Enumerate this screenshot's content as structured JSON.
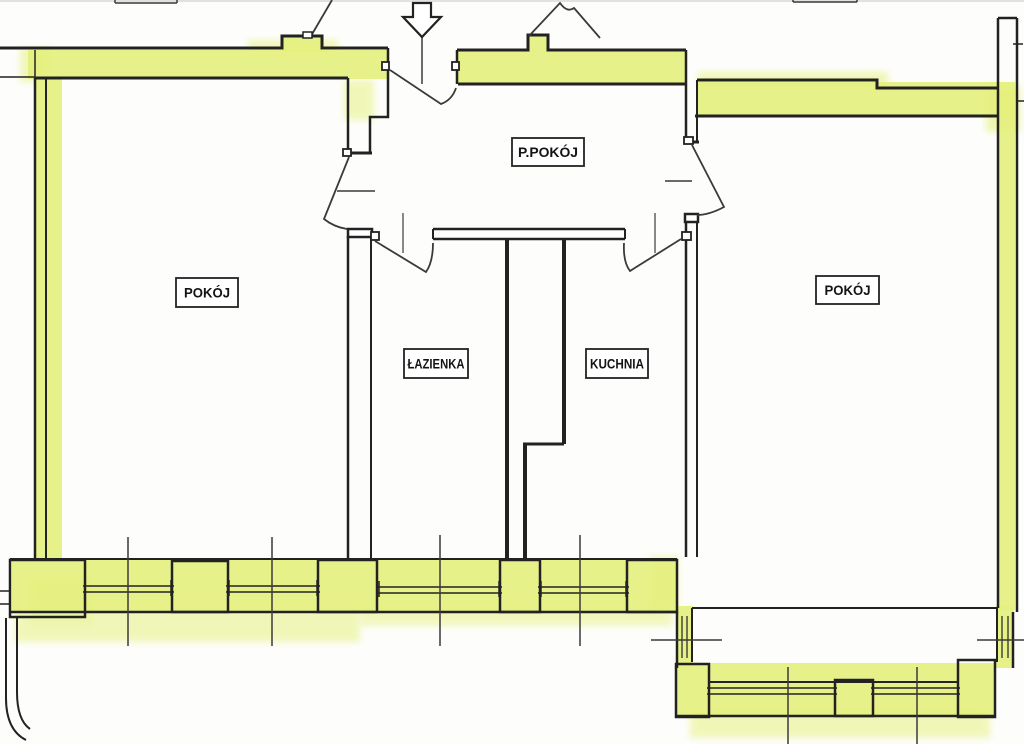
{
  "title": "Apartment floor plan scan",
  "colors": {
    "paper": "#fdfdfb",
    "wall": "#222222",
    "thin": "#3a3a3a",
    "hl": "#e4f07c",
    "hl_soft": "#edf5a8",
    "label_text": "#141414",
    "artifact": "#cfcfcc"
  },
  "labels": [
    {
      "name": "room-label-ppokoj",
      "text": "P.POKÓJ",
      "x": 512,
      "y": 138,
      "w": 72,
      "h": 28,
      "tl": 60
    },
    {
      "name": "room-label-pokoj-left",
      "text": "POKÓJ",
      "x": 176,
      "y": 278,
      "w": 62,
      "h": 29,
      "tl": 46
    },
    {
      "name": "room-label-lazienka",
      "text": "ŁAZIENKA",
      "x": 404,
      "y": 349,
      "w": 64,
      "h": 29,
      "tl": 57
    },
    {
      "name": "room-label-kuchnia",
      "text": "KUCHNIA",
      "x": 586,
      "y": 349,
      "w": 62,
      "h": 29,
      "tl": 54
    },
    {
      "name": "room-label-pokoj-right",
      "text": "POKÓJ",
      "x": 816,
      "y": 276,
      "w": 63,
      "h": 28,
      "tl": 46
    }
  ],
  "shapes": [
    {
      "t": "r",
      "name": "scan-artifact-top",
      "x": 0,
      "y": 0,
      "w": 1024,
      "h": 2,
      "f": "artifact",
      "s": "none",
      "op": 0.6
    },
    {
      "t": "r",
      "name": "hl-bleed-top-left",
      "x": 248,
      "y": 40,
      "w": 90,
      "h": 12,
      "f": "hl_soft",
      "s": "none",
      "op": 0.8,
      "blur": true
    },
    {
      "t": "r",
      "name": "hl-bleed-band-start",
      "x": 20,
      "y": 48,
      "w": 30,
      "h": 34,
      "f": "hl_soft",
      "s": "none",
      "op": 0.8,
      "blur": true
    },
    {
      "t": "r",
      "name": "hl-bleed-right-band",
      "x": 698,
      "y": 72,
      "w": 190,
      "h": 14,
      "f": "hl_soft",
      "s": "none",
      "op": 0.85,
      "blur": true
    },
    {
      "t": "r",
      "name": "hl-bleed-right-wall-top",
      "x": 986,
      "y": 86,
      "w": 34,
      "h": 46,
      "f": "hl_soft",
      "s": "none",
      "op": 0.9,
      "blur": true
    },
    {
      "t": "r",
      "name": "hl-bleed-pillar",
      "x": 344,
      "y": 80,
      "w": 30,
      "h": 40,
      "f": "hl_soft",
      "s": "none",
      "op": 0.8,
      "blur": true
    },
    {
      "t": "r",
      "name": "hl-bleed-corner-room",
      "x": 30,
      "y": 578,
      "w": 62,
      "h": 48,
      "f": "hl_soft",
      "s": "none",
      "op": 0.85,
      "blur": true
    },
    {
      "t": "r",
      "name": "hl-bleed-below-bottom",
      "x": 15,
      "y": 608,
      "w": 345,
      "h": 34,
      "f": "hl_soft",
      "s": "none",
      "op": 0.8,
      "blur": true
    },
    {
      "t": "r",
      "name": "hl-bleed-below-kitchen",
      "x": 360,
      "y": 606,
      "w": 312,
      "h": 20,
      "f": "hl_soft",
      "s": "none",
      "op": 0.75,
      "blur": true
    },
    {
      "t": "r",
      "name": "hl-bleed-bay-left",
      "x": 650,
      "y": 556,
      "w": 28,
      "h": 54,
      "f": "hl_soft",
      "s": "none",
      "op": 0.8,
      "blur": true
    },
    {
      "t": "r",
      "name": "hl-bleed-bay-bottom",
      "x": 690,
      "y": 710,
      "w": 300,
      "h": 28,
      "f": "hl_soft",
      "s": "none",
      "op": 0.8,
      "blur": true
    },
    {
      "t": "r",
      "name": "hl-top-left-band",
      "x": 28,
      "y": 50,
      "w": 360,
      "h": 29,
      "f": "hl",
      "s": "none",
      "op": 0.9
    },
    {
      "t": "r",
      "name": "hl-bump-left",
      "x": 282,
      "y": 37,
      "w": 40,
      "h": 15,
      "f": "hl",
      "s": "none",
      "op": 0.9
    },
    {
      "t": "r",
      "name": "hl-top-mid-band",
      "x": 458,
      "y": 51,
      "w": 228,
      "h": 33,
      "f": "hl",
      "s": "none",
      "op": 0.9
    },
    {
      "t": "r",
      "name": "hl-bump-mid",
      "x": 528,
      "y": 36,
      "w": 20,
      "h": 16,
      "f": "hl",
      "s": "none",
      "op": 0.9
    },
    {
      "t": "r",
      "name": "hl-right-room-band",
      "x": 697,
      "y": 82,
      "w": 318,
      "h": 34,
      "f": "hl",
      "s": "none",
      "op": 0.9
    },
    {
      "t": "r",
      "name": "hl-left-wall",
      "x": 36,
      "y": 79,
      "w": 26,
      "h": 480,
      "f": "hl",
      "s": "none",
      "op": 0.9
    },
    {
      "t": "r",
      "name": "hl-right-wall",
      "x": 999,
      "y": 90,
      "w": 16,
      "h": 520,
      "f": "hl",
      "s": "none",
      "op": 0.9
    },
    {
      "t": "r",
      "name": "hl-bottom-band",
      "x": 12,
      "y": 558,
      "w": 665,
      "h": 55,
      "f": "hl",
      "s": "none",
      "op": 0.9
    },
    {
      "t": "r",
      "name": "hl-bay-left",
      "x": 676,
      "y": 606,
      "w": 17,
      "h": 62,
      "f": "hl",
      "s": "none",
      "op": 0.9
    },
    {
      "t": "r",
      "name": "hl-bay-bottom",
      "x": 676,
      "y": 663,
      "w": 319,
      "h": 54,
      "f": "hl",
      "s": "none",
      "op": 0.9
    },
    {
      "t": "r",
      "name": "hl-bay-right",
      "x": 996,
      "y": 606,
      "w": 18,
      "h": 62,
      "f": "hl",
      "s": "none",
      "op": 0.9
    },
    {
      "t": "p",
      "name": "wall-top-left-outer",
      "d": "M0,48 H282 V36 H322 V48 H388",
      "sw": 3
    },
    {
      "t": "p",
      "name": "wall-top-left-inner-thin",
      "d": "M0,77 H35",
      "sw": 1.5
    },
    {
      "t": "p",
      "name": "wall-top-left-inner",
      "d": "M35,78 H348",
      "sw": 3
    },
    {
      "t": "p",
      "name": "wall-party-tick-left",
      "d": "M35,50 V78",
      "sw": 1.5
    },
    {
      "t": "p",
      "name": "wall-entry-pillar-left",
      "d": "M348,78 V155",
      "sw": 2.5
    },
    {
      "t": "p",
      "name": "wall-entry-pillar-right",
      "d": "M388,48 V117 H370 V153",
      "sw": 2.5
    },
    {
      "t": "p",
      "name": "wall-entry-pillar-cap",
      "d": "M346,153 H372",
      "sw": 3
    },
    {
      "t": "p",
      "name": "wall-top-mid-outer",
      "d": "M457,50 H528 V35 H548 V50 H686",
      "sw": 3
    },
    {
      "t": "p",
      "name": "wall-top-mid-inner",
      "d": "M458,84 H686",
      "sw": 3
    },
    {
      "t": "p",
      "name": "wall-top-mid-left-end",
      "d": "M457,50 V84",
      "sw": 2.5
    },
    {
      "t": "p",
      "name": "wall-divider-stub-left",
      "d": "M686,50 V142",
      "sw": 2.5
    },
    {
      "t": "p",
      "name": "wall-divider-stub-right",
      "d": "M697,116 V142",
      "sw": 2
    },
    {
      "t": "p",
      "name": "wall-divider-stub-cap",
      "d": "M684,142 H699",
      "sw": 3
    },
    {
      "t": "p",
      "name": "wall-right-room-top-outer",
      "d": "M697,80 H877 V88 H997",
      "sw": 3
    },
    {
      "t": "p",
      "name": "wall-right-room-top-inner",
      "d": "M695,116 H998",
      "sw": 3
    },
    {
      "t": "p",
      "name": "wall-right-room-top-left-end",
      "d": "M697,80 V116",
      "sw": 2
    },
    {
      "t": "p",
      "name": "wall-right-outer-edge",
      "d": "M1017,18 V612",
      "sw": 2.5
    },
    {
      "t": "p",
      "name": "wall-right-inner-edge",
      "d": "M998,18 V608",
      "sw": 2.5
    },
    {
      "t": "p",
      "name": "wall-right-top-cap",
      "d": "M998,18 H1017",
      "sw": 2.5
    },
    {
      "t": "p",
      "name": "wall-right-tick",
      "d": "M1013,44 H1023",
      "sw": 1.5
    },
    {
      "t": "p",
      "name": "wall-right-edge-line",
      "d": "M1017,101 H1024",
      "sw": 1.5
    },
    {
      "t": "p",
      "name": "wall-left-outer-edge",
      "d": "M35,78 V558",
      "sw": 2.5
    },
    {
      "t": "p",
      "name": "wall-left-inner-edge",
      "d": "M46,78 V558",
      "sw": 2
    },
    {
      "t": "p",
      "name": "wall-bath-divider-left",
      "d": "M348,236 V558",
      "sw": 2.5
    },
    {
      "t": "p",
      "name": "wall-bath-divider-right",
      "d": "M371,236 V558",
      "sw": 2
    },
    {
      "t": "r",
      "name": "door-frame-head-left-room",
      "x": 348,
      "y": 229,
      "w": 24,
      "h": 8,
      "f": "#ffffff",
      "s": "wall",
      "sw": 2.5
    },
    {
      "t": "p",
      "name": "wall-bath-kitchen-top-a",
      "d": "M433,229 H625",
      "sw": 2.5
    },
    {
      "t": "p",
      "name": "wall-bath-kitchen-top-b",
      "d": "M433,239 H625",
      "sw": 2.5
    },
    {
      "t": "p",
      "name": "wall-bath-kitchen-top-caps",
      "d": "M433,229 V239 M625,229 V239",
      "sw": 2
    },
    {
      "t": "p",
      "name": "wall-bath-right",
      "d": "M507,240 V558",
      "sw": 4
    },
    {
      "t": "p",
      "name": "wall-kitchen-left-upper",
      "d": "M564,240 V444",
      "sw": 4
    },
    {
      "t": "p",
      "name": "wall-kitchen-jog",
      "d": "M523,444 H564",
      "sw": 3
    },
    {
      "t": "p",
      "name": "wall-kitchen-left-lower",
      "d": "M525,444 V558",
      "sw": 4
    },
    {
      "t": "p",
      "name": "wall-hall-right-divider-a",
      "d": "M686,215 V557",
      "sw": 2.5
    },
    {
      "t": "p",
      "name": "wall-hall-right-divider-b",
      "d": "M697,215 V557",
      "sw": 2
    },
    {
      "t": "r",
      "name": "door-frame-head-right-room",
      "x": 685,
      "y": 214,
      "w": 13,
      "h": 8,
      "f": "#ffffff",
      "s": "wall",
      "sw": 2.5
    },
    {
      "t": "p",
      "name": "wall-bottom-inner",
      "d": "M10,559 H677",
      "sw": 2
    },
    {
      "t": "p",
      "name": "wall-bottom-outer",
      "d": "M10,612 H677",
      "sw": 2.5
    },
    {
      "t": "r",
      "name": "pier-corner-left",
      "x": 10,
      "y": 560,
      "w": 75,
      "h": 57,
      "f": "none",
      "s": "wall",
      "sw": 2.5
    },
    {
      "t": "p",
      "name": "pier-corner-notch",
      "d": "M0,591 H10 M0,604 H10",
      "sw": 1.5
    },
    {
      "t": "r",
      "name": "pier-a",
      "x": 172,
      "y": 561,
      "w": 56,
      "h": 51,
      "f": "none",
      "s": "wall",
      "sw": 2.5
    },
    {
      "t": "r",
      "name": "pier-b",
      "x": 318,
      "y": 560,
      "w": 59,
      "h": 52,
      "f": "none",
      "s": "wall",
      "sw": 2.5
    },
    {
      "t": "r",
      "name": "pier-c",
      "x": 500,
      "y": 560,
      "w": 40,
      "h": 52,
      "f": "none",
      "s": "wall",
      "sw": 2.5
    },
    {
      "t": "r",
      "name": "pier-d",
      "x": 627,
      "y": 560,
      "w": 50,
      "h": 52,
      "f": "none",
      "s": "wall",
      "sw": 2.5
    },
    {
      "t": "p",
      "name": "window-sills-bottom",
      "d": "M83,586 H174 M83,592 H174 M226,586 H320 M226,592 H320 M376,587 H502 M376,593 H502 M538,587 H629 M538,593 H629",
      "sw": 1.5
    },
    {
      "t": "p",
      "name": "window-jambs-bottom",
      "d": "M85,580 V596 M171,580 V596 M229,580 V596 M317,580 V596 M379,581 V597 M499,581 V597 M541,581 V597 M626,581 V597",
      "sw": 1.5
    },
    {
      "t": "p",
      "name": "wall-below-corner",
      "d": "M6,618 V698 Q6,730 26,740 M17,618 V692 Q17,720 30,729",
      "sw": 2
    },
    {
      "t": "p",
      "name": "wall-bay-opening-line",
      "d": "M692,608 H997",
      "sw": 2
    },
    {
      "t": "p",
      "name": "wall-bay-left-outer",
      "d": "M677,612 V668",
      "sw": 2.5
    },
    {
      "t": "p",
      "name": "wall-bay-left-inner",
      "d": "M692,608 V662",
      "sw": 2
    },
    {
      "t": "p",
      "name": "window-bay-left",
      "d": "M682,616 V658 M687,616 V658",
      "sw": 1.2
    },
    {
      "t": "r",
      "name": "pier-bay-left",
      "x": 676,
      "y": 664,
      "w": 33,
      "h": 53,
      "f": "none",
      "s": "wall",
      "sw": 2.5
    },
    {
      "t": "p",
      "name": "wall-bay-bottom-inner",
      "d": "M709,682 H958",
      "sw": 2
    },
    {
      "t": "p",
      "name": "window-sills-bay",
      "d": "M707,688 H837 M707,694 H837 M871,688 H960 M871,694 H960",
      "sw": 1.5
    },
    {
      "t": "p",
      "name": "wall-bay-bottom-outer",
      "d": "M676,716 H995",
      "sw": 2.5
    },
    {
      "t": "r",
      "name": "pier-bay-mid",
      "x": 835,
      "y": 680,
      "w": 38,
      "h": 36,
      "f": "none",
      "s": "wall",
      "sw": 2.5
    },
    {
      "t": "r",
      "name": "pier-bay-right",
      "x": 958,
      "y": 660,
      "w": 37,
      "h": 57,
      "f": "none",
      "s": "wall",
      "sw": 2.5
    },
    {
      "t": "p",
      "name": "wall-bay-right-inner",
      "d": "M997,608 V662",
      "sw": 2
    },
    {
      "t": "p",
      "name": "wall-bay-right-outer",
      "d": "M1013,612 V668",
      "sw": 2.5
    },
    {
      "t": "p",
      "name": "window-bay-right",
      "d": "M1002,616 V658 M1008,616 V658",
      "sw": 1.2
    },
    {
      "t": "p",
      "name": "threshold-left-door",
      "d": "M337,191 H375",
      "sw": 1.5,
      "s": "thin"
    },
    {
      "t": "p",
      "name": "threshold-right-door",
      "d": "M665,181 H692",
      "sw": 1.5,
      "s": "thin"
    },
    {
      "t": "p",
      "name": "tick-bath-door",
      "d": "M403,213 V253",
      "sw": 1.2,
      "s": "thin"
    },
    {
      "t": "p",
      "name": "tick-kitchen-door",
      "d": "M655,213 V253",
      "sw": 1.2,
      "s": "thin"
    },
    {
      "t": "p",
      "name": "window-axes-bottom",
      "d": "M128,537 V646 M272,537 V646 M440,535 V646 M580,535 V646",
      "sw": 1.5,
      "s": "thin"
    },
    {
      "t": "p",
      "name": "window-axes-bay",
      "d": "M788,667 V744 M917,667 V744 M651,640 H722 M977,640 H1024",
      "sw": 1.5,
      "s": "thin"
    },
    {
      "t": "p",
      "name": "stair-diagonal-left",
      "d": "M332,0 L311,36",
      "sw": 1.8,
      "s": "thin"
    },
    {
      "t": "r",
      "name": "stair-door-tick",
      "x": 303,
      "y": 32,
      "w": 9,
      "h": 6,
      "f": "#ffffff",
      "s": "wall",
      "sw": 1.5
    },
    {
      "t": "p",
      "name": "stair-diagonal-right",
      "d": "M529,36 L560,3 Q567,13 574,8 L600,38",
      "sw": 1.8,
      "s": "thin"
    },
    {
      "t": "p",
      "name": "cutoff-label-box-left",
      "d": "M115,3 H177 M115,0 V3 M177,0 V3",
      "sw": 1.5,
      "s": "thin"
    },
    {
      "t": "p",
      "name": "cutoff-label-box-right",
      "d": "M793,2 H857 M793,0 V2 M857,0 V2",
      "sw": 1.5,
      "s": "thin"
    },
    {
      "t": "r",
      "name": "jamb-entrance-left",
      "x": 382,
      "y": 62,
      "w": 7,
      "h": 8,
      "f": "#ffffff",
      "s": "wall",
      "sw": 1.8
    },
    {
      "t": "r",
      "name": "jamb-entrance-right",
      "x": 452,
      "y": 62,
      "w": 7,
      "h": 8,
      "f": "#ffffff",
      "s": "wall",
      "sw": 1.8
    },
    {
      "t": "r",
      "name": "hinge-left-room-door",
      "x": 343,
      "y": 149,
      "w": 8,
      "h": 7,
      "f": "#ffffff",
      "s": "wall",
      "sw": 1.8
    },
    {
      "t": "r",
      "name": "hinge-right-room-door",
      "x": 684,
      "y": 137,
      "w": 9,
      "h": 7,
      "f": "#ffffff",
      "s": "wall",
      "sw": 1.8
    },
    {
      "t": "r",
      "name": "hinge-bath-door",
      "x": 371,
      "y": 232,
      "w": 8,
      "h": 8,
      "f": "#ffffff",
      "s": "wall",
      "sw": 1.8
    },
    {
      "t": "r",
      "name": "hinge-kitchen-door",
      "x": 682,
      "y": 232,
      "w": 9,
      "h": 8,
      "f": "#ffffff",
      "s": "wall",
      "sw": 1.8
    },
    {
      "t": "p",
      "name": "door-swing-entrance",
      "d": "M390,70 L441,104 Q452,100 456,88",
      "sw": 1.8,
      "s": "thin"
    },
    {
      "t": "p",
      "name": "door-swing-left-room",
      "d": "M349,157 L324,219 Q334,227 347,229",
      "sw": 1.8,
      "s": "thin"
    },
    {
      "t": "p",
      "name": "door-swing-bath",
      "d": "M375,241 L426,272 Q433,262 433,243",
      "sw": 1.8,
      "s": "thin"
    },
    {
      "t": "p",
      "name": "door-swing-kitchen",
      "d": "M681,239 L630,271 Q623,262 624,243",
      "sw": 1.8,
      "s": "thin"
    },
    {
      "t": "p",
      "name": "door-swing-right-room",
      "d": "M692,145 L724,207 Q709,215 697,215",
      "sw": 1.8,
      "s": "thin"
    },
    {
      "t": "p",
      "name": "entrance-arrow-stem",
      "d": "M422,36 V84",
      "sw": 1.5,
      "s": "thin"
    },
    {
      "t": "p",
      "name": "entrance-arrow-icon",
      "d": "M413,3 H431 V17 H441 L422,37 L403,17 H413 Z",
      "sw": 2.2,
      "f": "#ffffff"
    }
  ]
}
